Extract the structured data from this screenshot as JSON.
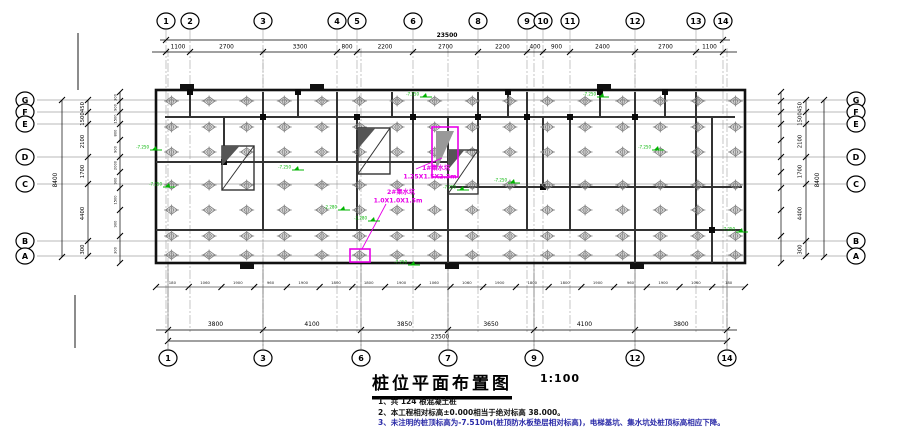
{
  "title": {
    "text": "桩位平面布置图",
    "scale": "1:100"
  },
  "notes": [
    {
      "text": "1、共 124 根混凝土桩",
      "color": "#111111"
    },
    {
      "text": "2、本工程相对标高±0.000相当于绝对标高 38.000。",
      "color": "#111111"
    },
    {
      "text": "3、未注明的桩顶标高为-7.510m(桩顶防水板垫层相对标高)，电梯基坑、集水坑处桩顶标高相应下降。",
      "color": "#2b2ba8"
    }
  ],
  "axes": {
    "top": [
      "1",
      "2",
      "3",
      "4",
      "5",
      "6",
      "8",
      "9",
      "10",
      "11",
      "12",
      "13",
      "14"
    ],
    "bottom": [
      "1",
      "3",
      "6",
      "7",
      "9",
      "12",
      "14"
    ],
    "left": [
      "G",
      "F",
      "E",
      "D",
      "C",
      "B",
      "A"
    ],
    "right": [
      "G",
      "F",
      "E",
      "D",
      "C",
      "B",
      "A"
    ]
  },
  "dims": {
    "top": {
      "overall": "23500",
      "segments": [
        "1100",
        "2700",
        "3300",
        "800",
        "2200",
        "2700",
        "2200",
        "400",
        "900",
        "2400",
        "2700",
        "1100"
      ]
    },
    "bottom": {
      "overall": "23500",
      "segments": [
        "3800",
        "4100",
        "3850",
        "3650",
        "4100",
        "3800"
      ],
      "sub": [
        "180",
        "1060",
        "1900",
        "960",
        "1900",
        "1800",
        "1800",
        "1900",
        "1060",
        "1060",
        "1900",
        "1800",
        "1800",
        "1900",
        "960",
        "1900",
        "1060",
        "180"
      ]
    },
    "left": {
      "overall": "8400",
      "segments": [
        "450",
        "1500",
        "2100",
        "1700",
        "4400",
        "300"
      ],
      "sub": [
        "300",
        "900",
        "1500",
        "800",
        "900",
        "2000",
        "900",
        "1500",
        "900",
        "300"
      ]
    },
    "right": {
      "overall": "8400",
      "segments": [
        "450",
        "1500",
        "2100",
        "1700",
        "4400",
        "300"
      ]
    }
  },
  "annotations": {
    "sump1": {
      "line1": "1#集水坑",
      "line2": "1.25X1.5X2.3m"
    },
    "sump2": {
      "line1": "2#集水坑",
      "line2": "1.0X1.0X1.5m"
    },
    "elevation_values": [
      "-7.250",
      "-2.280"
    ]
  },
  "colors": {
    "magenta": "#e800e8",
    "green": "#00b400",
    "line": "#000000",
    "wall": "#333333",
    "pile": "#7d7d7d"
  }
}
